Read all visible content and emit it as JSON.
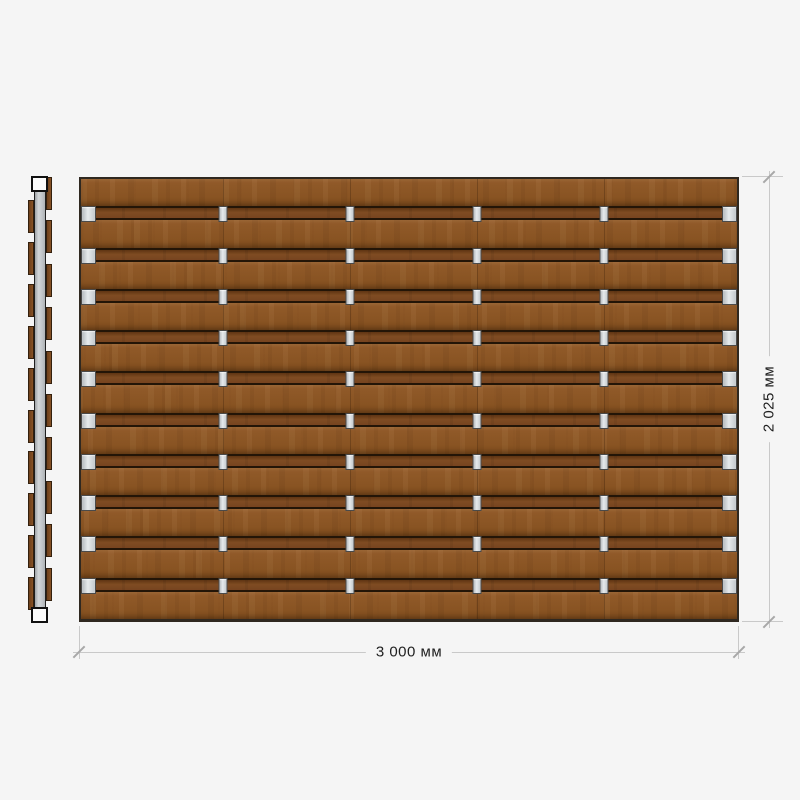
{
  "drawing": {
    "type": "fence-panel-technical-drawing",
    "dimensions": {
      "width_label": "3 000 мм",
      "height_label": "2 025 мм"
    },
    "front_view": {
      "plank_count": 11,
      "band_count": 10,
      "clips_per_band": 6,
      "clip_columns_pct": [
        0,
        21.7,
        41.0,
        60.4,
        79.7,
        100
      ]
    },
    "side_view": {
      "left_plank_count": 10,
      "right_plank_count": 10,
      "caps": 2
    },
    "colors": {
      "wood_base": "#8b5526",
      "band_wood": "#7c4920",
      "separator_dark": "#231507",
      "clip_fill": "#ccd1d5",
      "post_fill": "#c6cacd",
      "dim_line": "#c9c9c9",
      "dim_text": "#1f1f1f",
      "background": "#f5f5f5"
    }
  }
}
